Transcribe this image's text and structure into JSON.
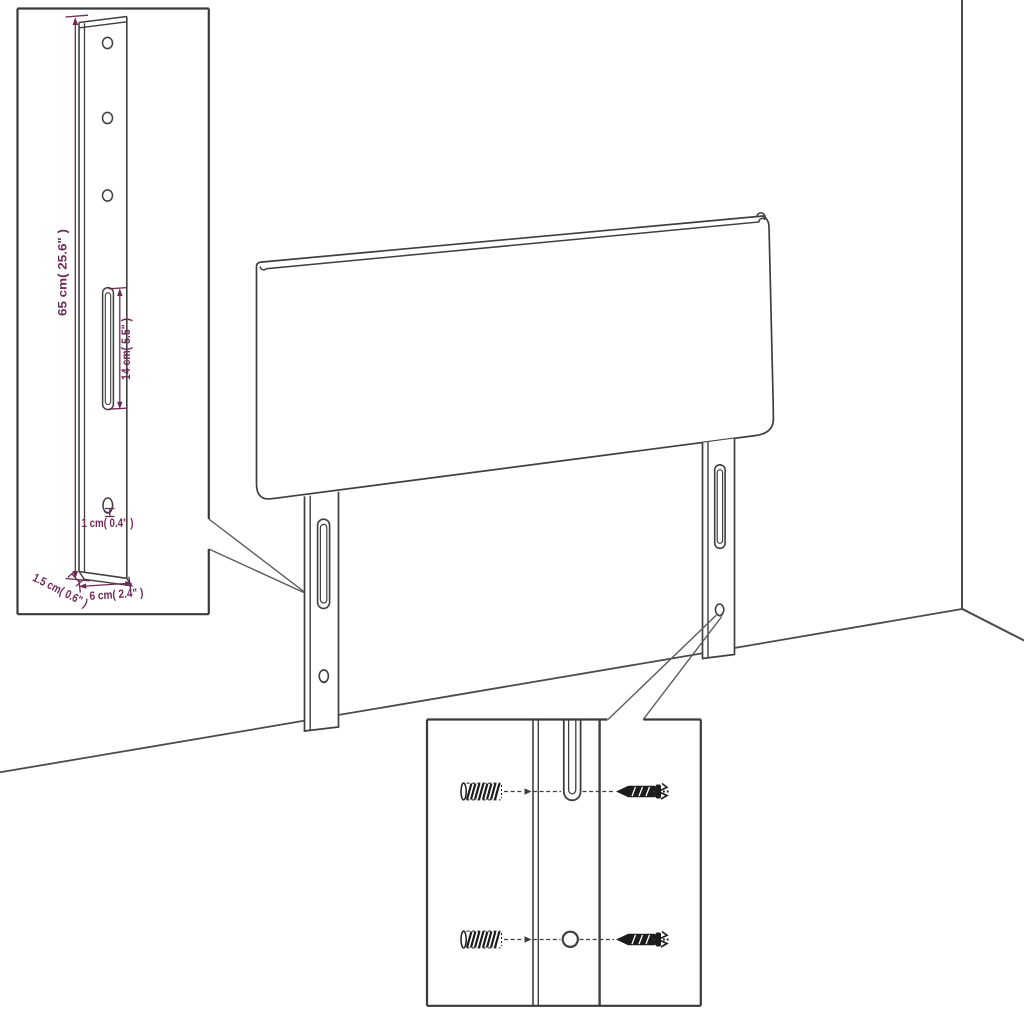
{
  "figure": {
    "subject": "Headboard assembly diagram with wall-mount leg dimension inset and fixing hardware detail inset",
    "background": "#ffffff",
    "line_color": "#3f3f3f",
    "accent_color": "#6e2a57",
    "hardware_color": "#1c1c1c",
    "legs_count": 2,
    "bracket_hole_count": 3
  },
  "dimension_inset": {
    "height_label": "65 cm( 25.6\" )",
    "slot_label": "14 cm( 5.5\" )",
    "hole_label": "1 cm( 0.4\" )",
    "thickness_label": "1.5 cm( 0.6\" )",
    "width_label": "6 cm( 2.4\" )"
  },
  "hardware_inset": {
    "items": [
      "wall-anchor",
      "screw",
      "mount-slot",
      "mount-hole"
    ]
  }
}
